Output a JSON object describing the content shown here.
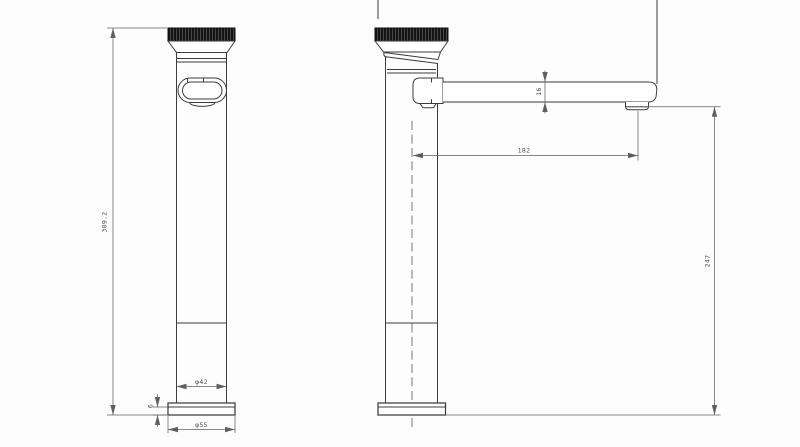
{
  "colors": {
    "background": "#fdfdfd",
    "outline": "#3c3c3c",
    "dimension_lines": "#5f5f5f",
    "dimension_text": "#4f4f4f",
    "knob_fill": "#141414"
  },
  "drawing": {
    "dimensions": {
      "overall_height": "309.2",
      "body_diameter": "φ42",
      "base_diameter": "φ55",
      "base_thickness": "6",
      "spout_reach": "182",
      "spout_height": "16",
      "outlet_height": "247"
    }
  }
}
